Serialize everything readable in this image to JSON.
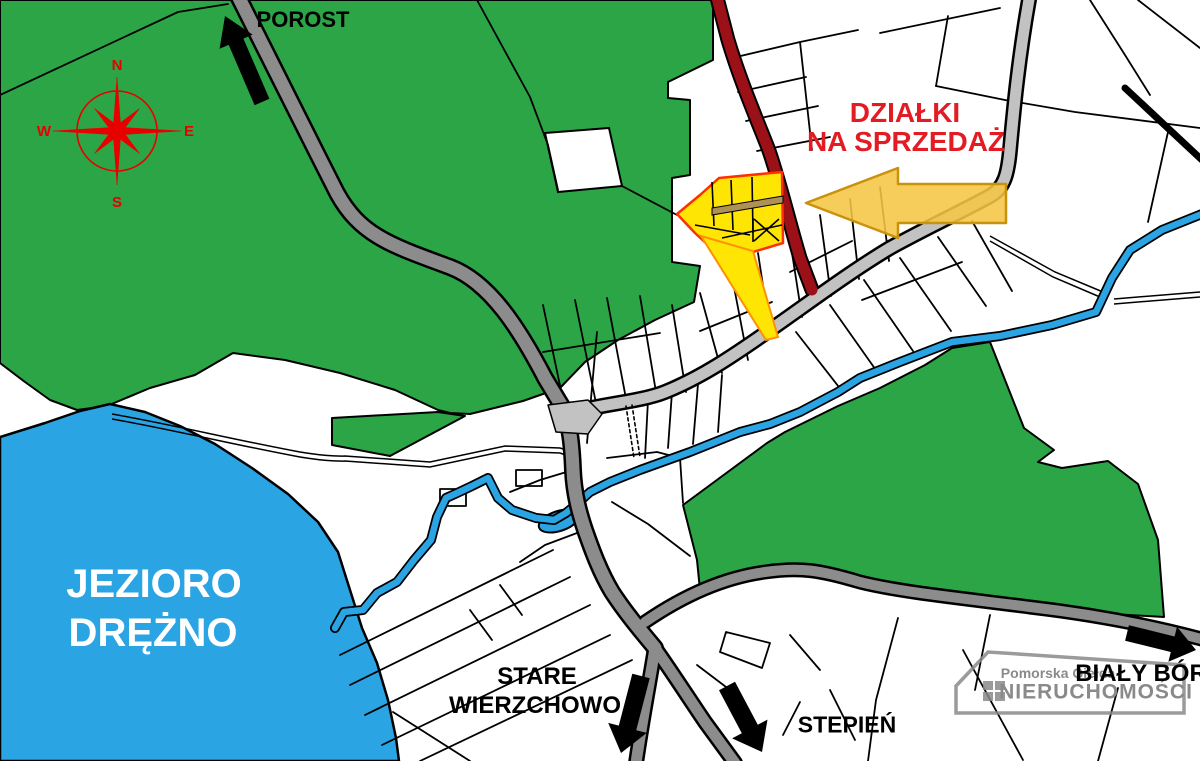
{
  "labels": {
    "porost": "POROST",
    "dzialki_line1": "DZIAŁKI",
    "dzialki_line2": "NA SPRZEDAŻ",
    "jezioro_line1": "JEZIORO",
    "jezioro_line2": "DRĘŻNO",
    "stare_line1": "STARE",
    "stare_line2": "WIERZCHOWO",
    "stepien": "STEPIEŃ",
    "bialy_bor": "BIAŁY BÓR"
  },
  "compass": {
    "n": "N",
    "e": "E",
    "s": "S",
    "w": "W"
  },
  "logo": {
    "line1": "Pomorska Giełda",
    "line2": "NIERUCHOMOŚCI"
  },
  "colors": {
    "forest": "#2BA546",
    "water": "#2BA4E4",
    "road_dark": "#8C8C8C",
    "road_light": "#C2C2C2",
    "road_closed": "#9C1118",
    "plot_yellow": "#FFE504",
    "plot_border": "#FF2F00",
    "plot_access": "#FF9000",
    "plot_path_tan": "#AE9157",
    "arrow_gold": "#F5C544",
    "arrow_gold_border": "#C8920B",
    "text_red": "#E31B23",
    "compass_red": "#E80000",
    "logo_gray": "#8A8A8A",
    "text_black": "#000000",
    "text_white": "#FFFFFF",
    "outline": "#000000"
  }
}
